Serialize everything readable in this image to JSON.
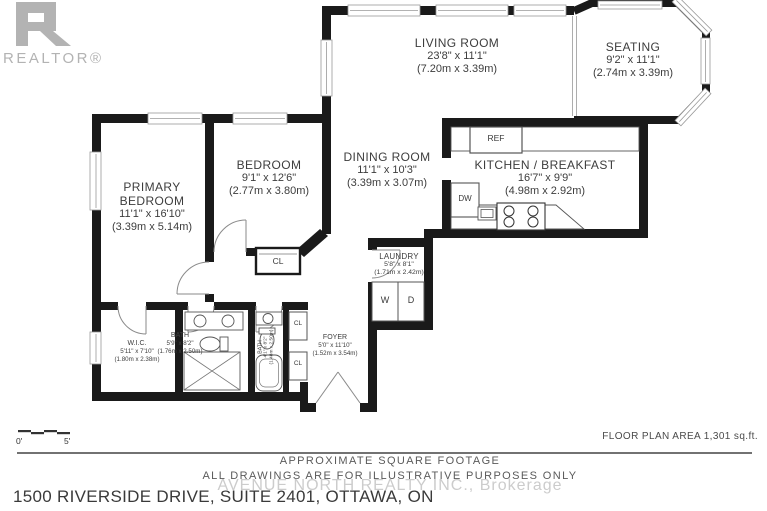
{
  "branding": {
    "realtor_wordmark": "REALTOR®"
  },
  "rooms": {
    "living": {
      "name": "LIVING ROOM",
      "dims": "23'8\" x 11'1\"",
      "metric": "(7.20m x 3.39m)"
    },
    "seating": {
      "name": "SEATING",
      "dims": "9'2\" x 11'1\"",
      "metric": "(2.74m x 3.39m)"
    },
    "dining": {
      "name": "DINING ROOM",
      "dims": "11'1\" x 10'3\"",
      "metric": "(3.39m x 3.07m)"
    },
    "kitchen": {
      "name": "KITCHEN / BREAKFAST",
      "dims": "16'7\" x 9'9\"",
      "metric": "(4.98m x 2.92m)"
    },
    "bedroom": {
      "name": "BEDROOM",
      "dims": "9'1\" x 12'6\"",
      "metric": "(2.77m x 3.80m)"
    },
    "primary": {
      "name1": "PRIMARY",
      "name2": "BEDROOM",
      "dims": "11'1\" x 16'10\"",
      "metric": "(3.39m x 5.14m)"
    },
    "laundry": {
      "name": "LAUNDRY",
      "dims": "5'8\" x 8'1\"",
      "metric": "(1.71m x 2.42m)"
    },
    "wic": {
      "name": "W.I.C.",
      "dims": "5'11\" x 7'10\"",
      "metric": "(1.80m x 2.38m)"
    },
    "bath": {
      "name": "BATH",
      "dims": "5'9\" x 8'2\"",
      "metric": "(1.76m x 2.50m)"
    },
    "bath2": {
      "name": "BATH",
      "dims": "4'1\" x 8'2\"",
      "metric": "(1.48m x 2.50m)"
    },
    "foyer": {
      "name": "FOYER",
      "dims": "5'0\" x 11'10\"",
      "metric": "(1.52m x 3.54m)"
    }
  },
  "fixtures": {
    "ref": "REF",
    "dw": "DW",
    "washer": "W",
    "dryer": "D",
    "closet": "CL"
  },
  "scale_bar": {
    "start": "0'",
    "end": "5'"
  },
  "footer": {
    "area": "FLOOR PLAN AREA 1,301 sq.ft.",
    "note1": "APPROXIMATE SQUARE FOOTAGE",
    "note2": "ALL DRAWINGS ARE FOR ILLUSTRATIVE PURPOSES ONLY",
    "watermark": "AVENUE NORTH REALTY INC., Brokerage",
    "address": "1500 RIVERSIDE DRIVE, SUITE 2401, OTTAWA, ON"
  }
}
